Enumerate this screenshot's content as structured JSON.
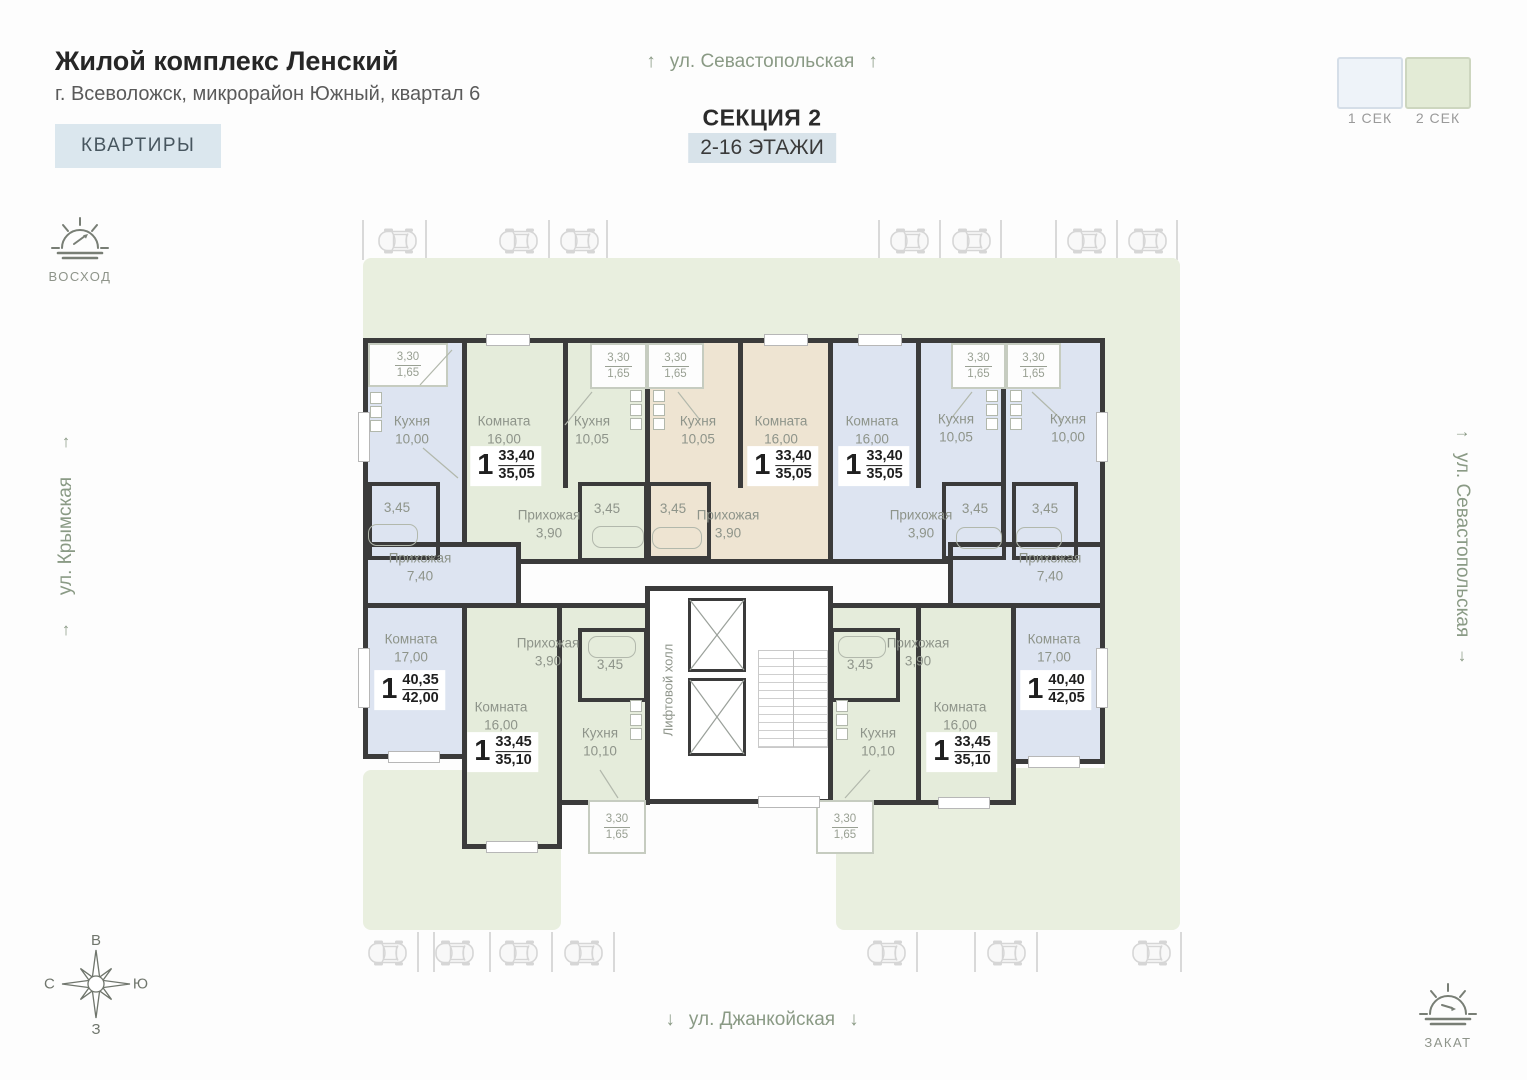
{
  "header": {
    "title": "Жилой комплекс Ленский",
    "subtitle": "г. Всеволожск, микрорайон Южный, квартал 6",
    "apartments_button": "КВАРТИРЫ"
  },
  "section": {
    "street_top": "ул. Севастопольская",
    "title": "СЕКЦИЯ 2",
    "floors": "2-16 ЭТАЖИ"
  },
  "legend": {
    "sec1": "1 СЕК",
    "sec2": "2 СЕК"
  },
  "streets": {
    "left": "ул. Крымская",
    "right": "ул. Севастопольская",
    "bottom": "ул. Джанкойская"
  },
  "sun": {
    "sunrise": "ВОСХОД",
    "sunset": "ЗАКАТ"
  },
  "compass": {
    "top": "В",
    "right": "Ю",
    "bottom": "З",
    "left": "С"
  },
  "arrows": {
    "up": "↑",
    "down": "↓",
    "right": "→"
  },
  "plan": {
    "lift_hall": "Лифтовой холл",
    "balcony": {
      "top": "3,30",
      "bottom": "1,65"
    },
    "apartments": [
      {
        "rooms": {
          "kitchen_name": "Кухня",
          "kitchen_area": "10,00",
          "bath_area": "3,45",
          "hall_name": "Прихожая",
          "hall_area": "7,40",
          "room_name": "Комната",
          "room_area": "17,00"
        },
        "tag": {
          "rooms": "1",
          "living_area": "40,35",
          "total_area": "42,00"
        }
      },
      {
        "rooms": {
          "room_name": "Комната",
          "room_area": "16,00",
          "kitchen_name": "Кухня",
          "kitchen_area": "10,05",
          "hall_name": "Прихожая",
          "hall_area": "3,90",
          "bath_area": "3,45"
        },
        "tag": {
          "rooms": "1",
          "living_area": "33,40",
          "total_area": "35,05"
        }
      },
      {
        "rooms": {
          "kitchen_name": "Кухня",
          "kitchen_area": "10,05",
          "room_name": "Комната",
          "room_area": "16,00",
          "hall_name": "Прихожая",
          "hall_area": "3,90",
          "bath_area": "3,45"
        },
        "tag": {
          "rooms": "1",
          "living_area": "33,40",
          "total_area": "35,05"
        }
      },
      {
        "rooms": {
          "room_name": "Комната",
          "room_area": "16,00",
          "kitchen_name": "Кухня",
          "kitchen_area": "10,05",
          "hall_name": "Прихожая",
          "hall_area": "3,90",
          "bath_area": "3,45"
        },
        "tag": {
          "rooms": "1",
          "living_area": "33,40",
          "total_area": "35,05"
        }
      },
      {
        "rooms": {
          "kitchen_name": "Кухня",
          "kitchen_area": "10,00",
          "bath_area": "3,45",
          "hall_name": "Прихожая",
          "hall_area": "7,40",
          "room_name": "Комната",
          "room_area": "17,00"
        },
        "tag": {
          "rooms": "1",
          "living_area": "40,40",
          "total_area": "42,05"
        }
      },
      {
        "rooms": {
          "hall_name": "Прихожая",
          "hall_area": "3,90",
          "bath_area": "3,45",
          "room_name": "Комната",
          "room_area": "16,00",
          "kitchen_name": "Кухня",
          "kitchen_area": "10,10"
        },
        "tag": {
          "rooms": "1",
          "living_area": "33,45",
          "total_area": "35,10"
        }
      },
      {
        "rooms": {
          "hall_name": "Прихожая",
          "hall_area": "3,90",
          "bath_area": "3,45",
          "kitchen_name": "Кухня",
          "kitchen_area": "10,10",
          "room_name": "Комната",
          "room_area": "16,00"
        },
        "tag": {
          "rooms": "1",
          "living_area": "33,45",
          "total_area": "35,10"
        }
      }
    ]
  },
  "colors": {
    "apartment_blue": "#dde4f1",
    "apartment_green": "#e5ecdb",
    "apartment_beige": "#eee4d2",
    "lawn": "#e9efdf",
    "wall": "#3b3b3b",
    "floors_badge_bg": "#d8e3ea",
    "button_bg": "#dbe7ee"
  }
}
